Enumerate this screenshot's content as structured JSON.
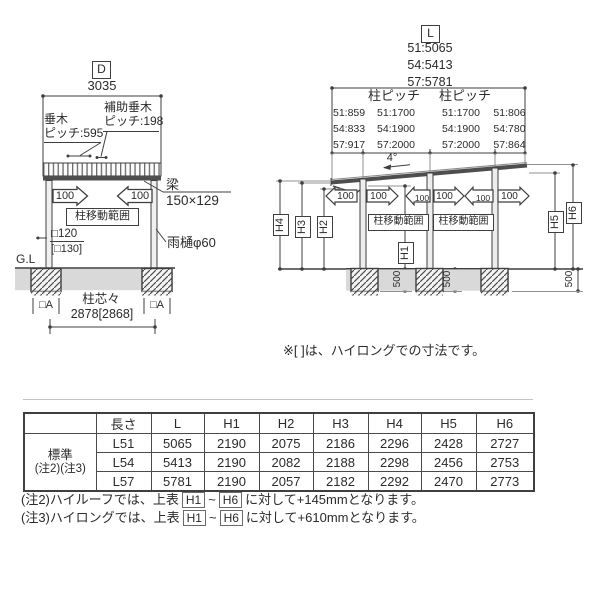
{
  "left_diagram": {
    "dim_label": "D",
    "dim_value": "3035",
    "rafter_line1": "垂木",
    "rafter_line2": "ピッチ:595",
    "aux_rafter_line1": "補助垂木",
    "aux_rafter_line2": "ピッチ:198",
    "beam_label": "梁",
    "beam_size": "150×129",
    "arrow_left_value": "100",
    "arrow_right_value": "100",
    "pillar_range": "柱移動範囲",
    "post_size": "□120",
    "post_size_alt": "[□130]",
    "gutter": "雨樋φ60",
    "ground_label": "G.L",
    "anchor_left": "□A",
    "anchor_right": "□A",
    "span_label": "柱芯々",
    "span_value": "2878[2868]"
  },
  "right_diagram": {
    "dim_label": "L",
    "length_values": [
      "51:5065",
      "54:5413",
      "57:5781"
    ],
    "pitch_header_1": "柱ピッチ",
    "pitch_header_2": "柱ピッチ",
    "pitch_rows": [
      [
        "51:859",
        "51:1700",
        "51:1700",
        "51:806"
      ],
      [
        "54:833",
        "54:1900",
        "54:1900",
        "54:780"
      ],
      [
        "57:917",
        "57:2000",
        "57:2000",
        "57:864"
      ]
    ],
    "slope": "4°",
    "arrows": [
      "100",
      "100",
      "100",
      "100",
      "100",
      "100"
    ],
    "pillar_range_1": "柱移動範囲",
    "pillar_range_2": "柱移動範囲",
    "h_labels": {
      "h1": "H1",
      "h2": "H2",
      "h3": "H3",
      "h4": "H4",
      "h5": "H5",
      "h6": "H6"
    },
    "foundation_depths": [
      "500",
      "500",
      "500"
    ]
  },
  "note_bracket": "※[ ]は、ハイロングでの寸法です。",
  "table": {
    "headers": [
      "長さ",
      "L",
      "H1",
      "H2",
      "H3",
      "H4",
      "H5",
      "H6"
    ],
    "row_group_line1": "標準",
    "row_group_line2": "(注2)(注3)",
    "rows": [
      {
        "length": "L51",
        "values": [
          "5065",
          "2190",
          "2075",
          "2186",
          "2296",
          "2428",
          "2727"
        ]
      },
      {
        "length": "L54",
        "values": [
          "5413",
          "2190",
          "2082",
          "2188",
          "2298",
          "2456",
          "2753"
        ]
      },
      {
        "length": "L57",
        "values": [
          "5781",
          "2190",
          "2057",
          "2182",
          "2292",
          "2470",
          "2773"
        ]
      }
    ]
  },
  "notes": {
    "note2_pre": "(注2)ハイルーフでは、上表",
    "note2_box1": "H1",
    "note2_tilde": "~",
    "note2_box2": "H6",
    "note2_post": "に対して+145mmとなります。",
    "note3_pre": "(注3)ハイロングでは、上表",
    "note3_box1": "H1",
    "note3_tilde": "~",
    "note3_box2": "H6",
    "note3_post": "に対して+610mmとなります。"
  },
  "colors": {
    "line": "#3f3f3f",
    "ground_fill": "#d9d9d9",
    "text": "#2b2b2b"
  }
}
